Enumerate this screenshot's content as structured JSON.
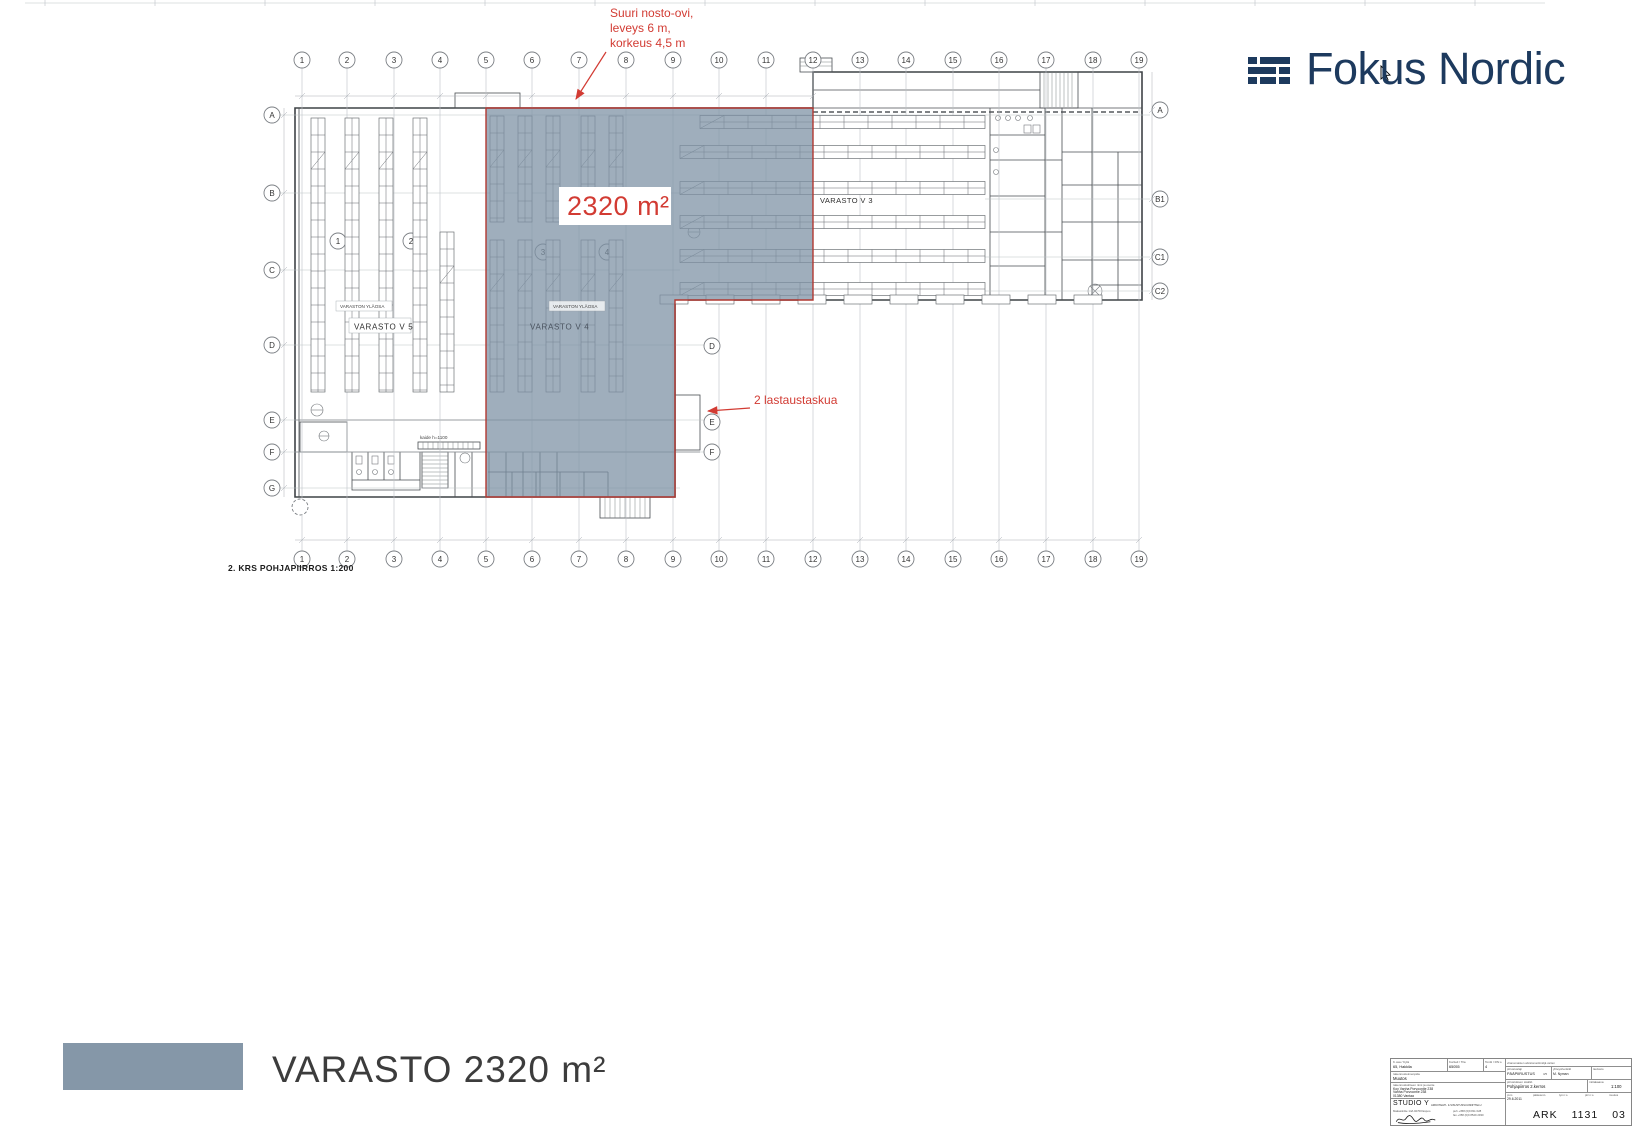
{
  "logo": {
    "text": "Fokus Nordic",
    "color": "#1d3a5e"
  },
  "annotations": {
    "door_line1": "Suuri nosto-ovi,",
    "door_line2": "leveys 6 m,",
    "door_line3": "korkeus 4,5 m",
    "area": "2320 m²",
    "dock": "2 lastaustaskua",
    "red_color": "#d23b33"
  },
  "plan": {
    "caption": "2. KRS POHJAPIIRROS 1:200",
    "labels": {
      "v5": "VARASTO  V 5",
      "v4": "VARASTO  V 4",
      "v3": "VARASTO V 3",
      "v5_upper": "VARASTON YLÄOSA",
      "v4_upper": "VARASTON YLÄOSA",
      "railing": "kaide h=1100"
    },
    "grid_cols": [
      "1",
      "2",
      "3",
      "4",
      "5",
      "6",
      "7",
      "8",
      "9",
      "10",
      "11",
      "12",
      "13",
      "14",
      "15",
      "16",
      "17",
      "18",
      "19"
    ],
    "grid_rows_left": [
      "A",
      "B",
      "C",
      "D",
      "E",
      "F",
      "G"
    ],
    "grid_rows_right": [
      "A",
      "B1",
      "C1",
      "C2"
    ],
    "grid_rows_inner": [
      "D",
      "E",
      "F"
    ],
    "ref_bubbles": [
      "1",
      "2",
      "3",
      "4"
    ]
  },
  "legend": {
    "swatch_color": "#8597a8",
    "label": "VARASTO 2320 m²"
  },
  "titleblock": {
    "cell1_label": "K.osa / Kylä",
    "cell1_value": "65, Hakkila",
    "cell2_label": "Kortteli / Tila",
    "cell2_value": "65055",
    "cell3_label": "Tontti / RN:o",
    "cell3_value": "4",
    "row2_label": "rakennustoimenpide",
    "row2_value": "Muutos",
    "row3_label": "rakennuskohteen nimi ja osoite",
    "row3_line1": "Koy Vanha Porvoontie 238",
    "row3_line2": "Vanha Porvoontie 238",
    "row3_line3": "01380 Vantaa",
    "studio_name": "STUDIO Y",
    "studio_sub": "ARKKITEHTI- & SISUSTUSSUUNNITTELU",
    "studio_addr": "Makasiinitie 14A   02700 Espoo",
    "studio_tel": "puh +358 (0)9 811 028",
    "studio_fax": "fax +358 (0)9 8529 2930",
    "archive_note": "viranomaisten arkistomerkintöjä varten",
    "type_label": "piirustuslaji",
    "type_value": "PÄÄPIIRUSTUS",
    "sheet": "3/5",
    "contact_label": "yhteyshenkilö",
    "contact_value": "M. Nyman",
    "file_label": "tiedosto",
    "content_label": "piirustuksen sisältö",
    "content_value": "Pohjapiirros 2.kerros",
    "scale_label": "mittakaava",
    "scale_value": "1:100",
    "r4h": [
      "pvm",
      "pääsuunn.",
      "työ n:o",
      "piir n:o",
      "muutos"
    ],
    "date_value": "29.6.2011",
    "code_a": "ARK",
    "code_b": "1131",
    "code_c": "03"
  }
}
